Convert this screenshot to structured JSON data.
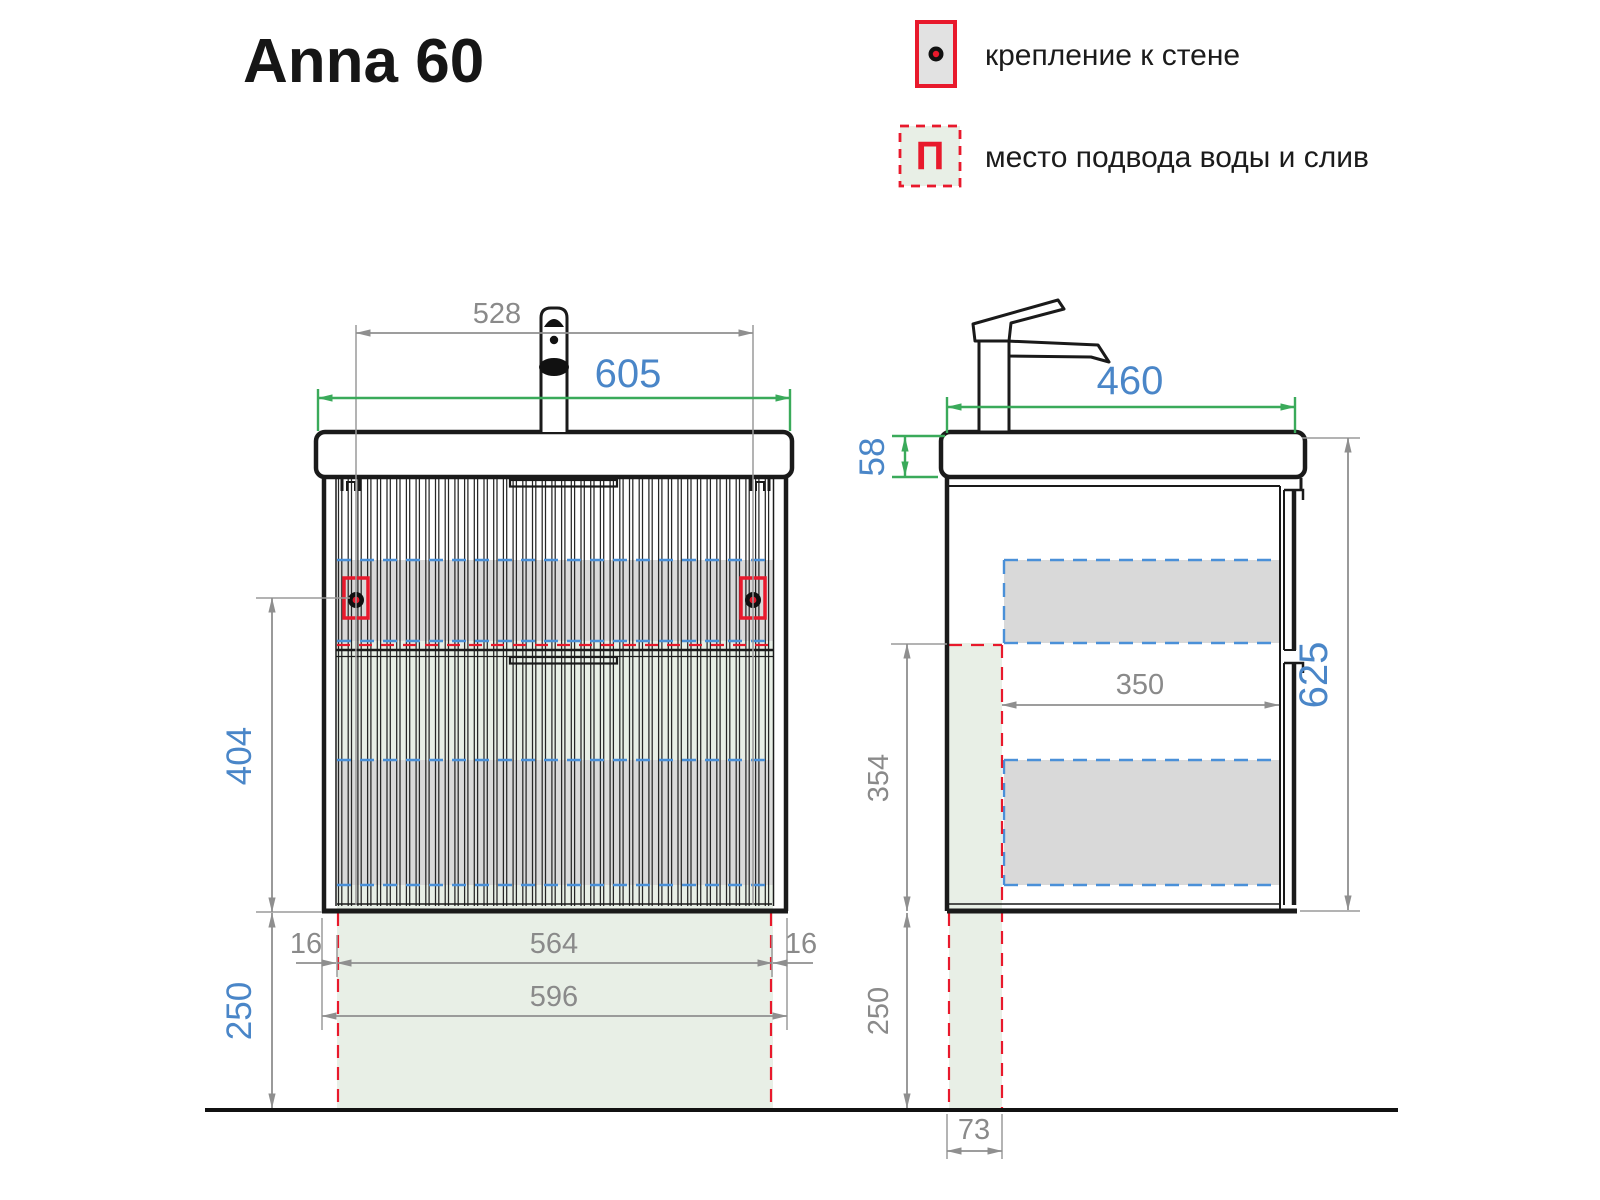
{
  "title": "Anna 60",
  "legend": {
    "wall_mount": "крепление к стене",
    "water_supply": "место подвода воды и слив",
    "supply_symbol": "П"
  },
  "front": {
    "dims": {
      "total_width": "605",
      "mount_span": "528",
      "mount_height": "404",
      "floor_gap": "250",
      "gap_left": "16",
      "inner_width": "564",
      "gap_right": "16",
      "body_width": "596"
    }
  },
  "side": {
    "dims": {
      "depth": "460",
      "basin_height": "58",
      "total_height": "625",
      "inner_depth": "350",
      "zone_height": "354",
      "floor_gap": "250",
      "zone_depth": "73"
    }
  },
  "colors": {
    "dim_blue": "#4a86c8",
    "dim_green": "#3aaa5a",
    "dim_gray": "#8a8a8a",
    "zone_gray": "#d9d9d9",
    "zone_green": "#e8efe6",
    "accent_red": "#e8192c",
    "dash_blue": "#4a90d8",
    "line_black": "#1a1a1a"
  }
}
